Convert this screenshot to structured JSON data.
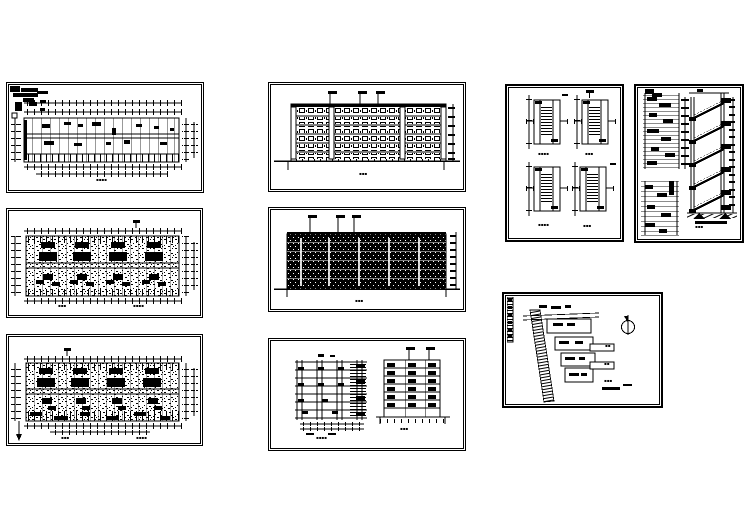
{
  "page": {
    "background": "#ffffff",
    "ink": "#000000",
    "description": "Architectural CAD drawing sheet with nine blueprint panels"
  },
  "marks": {
    "planA": {
      "title": "▪▪▪▪"
    },
    "planB": {
      "title_left": "▪▪▪",
      "title_right": "▪▪▪▪"
    },
    "planC": {
      "title_left": "▪▪▪",
      "title_right": "▪▪▪▪"
    },
    "elevFront": {
      "title": "▪▪▪"
    },
    "elevRear": {
      "title": "▪▪▪"
    },
    "sections": {
      "title_left": "▪▪▪▪",
      "title_right": "▪▪▪"
    },
    "stairPlans": {
      "t1": "▪▪▪▪",
      "t2": "▪▪▪",
      "t3": "▪▪▪▪",
      "t4": "▪▪▪"
    },
    "stairSection": {
      "title": "▪▪▪"
    },
    "site": {
      "title_line1": "▪▪▪",
      "callout1": "▪▪",
      "callout2": "▪▪"
    }
  }
}
